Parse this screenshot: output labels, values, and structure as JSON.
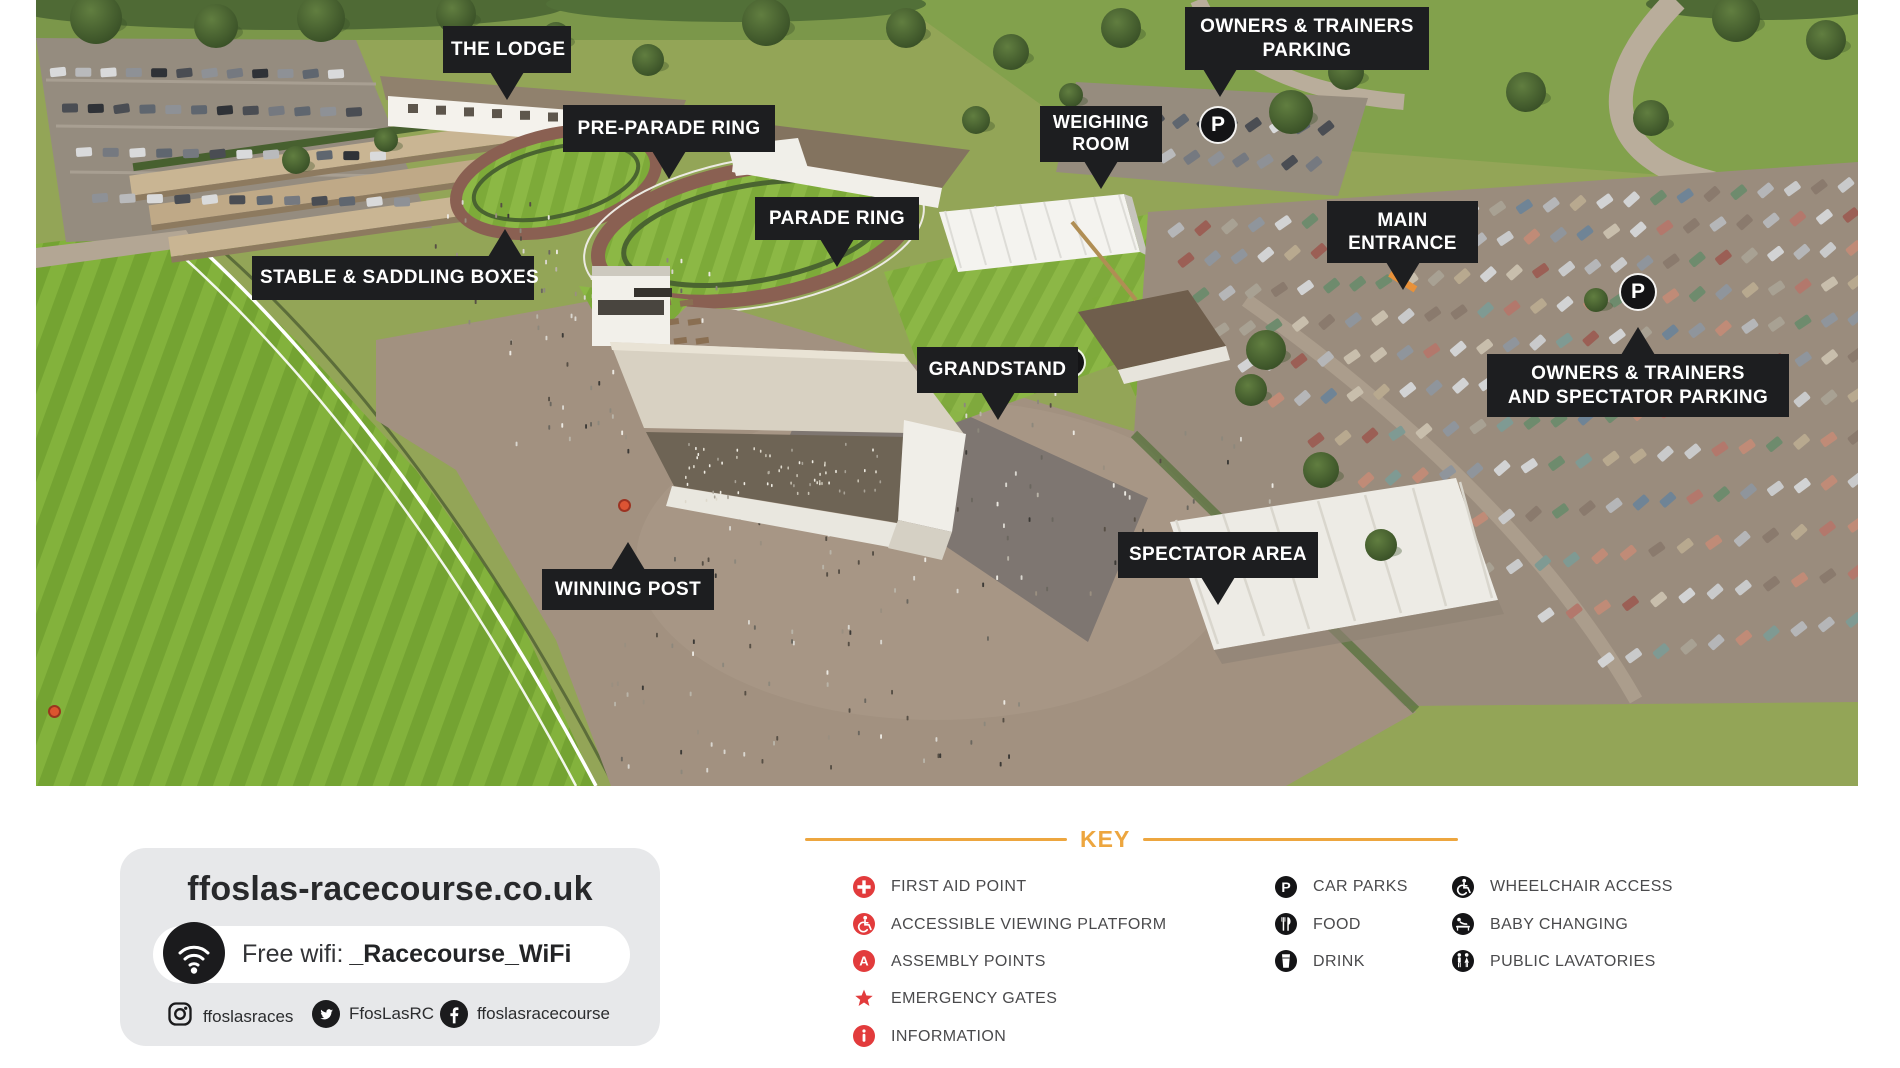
{
  "map": {
    "callouts": [
      {
        "id": "the-lodge",
        "lines": [
          "THE LODGE"
        ]
      },
      {
        "id": "pre-parade-ring",
        "lines": [
          "PRE-PARADE RING"
        ]
      },
      {
        "id": "owners-trainers-parking",
        "lines": [
          "OWNERS & TRAINERS",
          "PARKING"
        ]
      },
      {
        "id": "weighing-room",
        "lines": [
          "WEIGHING",
          "ROOM"
        ]
      },
      {
        "id": "stable-saddling-boxes",
        "lines": [
          "STABLE & SADDLING BOXES"
        ]
      },
      {
        "id": "parade-ring",
        "lines": [
          "PARADE RING"
        ]
      },
      {
        "id": "main-entrance",
        "lines": [
          "MAIN",
          "ENTRANCE"
        ]
      },
      {
        "id": "grandstand",
        "lines": [
          "GRANDSTAND"
        ]
      },
      {
        "id": "owners-trainers-spectator-parking",
        "lines": [
          "OWNERS & TRAINERS",
          "AND SPECTATOR PARKING"
        ]
      },
      {
        "id": "winning-post",
        "lines": [
          "WINNING POST"
        ]
      },
      {
        "id": "spectator-area",
        "lines": [
          "SPECTATOR AREA"
        ]
      }
    ],
    "markers": [
      {
        "type": "car-park",
        "glyph": "P"
      },
      {
        "type": "car-park",
        "glyph": "P"
      },
      {
        "type": "public-lavatories"
      },
      {
        "type": "point-marker"
      },
      {
        "type": "point-marker"
      }
    ]
  },
  "info_panel": {
    "website": "ffoslas-racecourse.co.uk",
    "wifi_label": "Free wifi:",
    "wifi_ssid": "_Racecourse_WiFi",
    "social": [
      {
        "network": "instagram",
        "handle": "ffoslasraces"
      },
      {
        "network": "twitter",
        "handle": "FfosLasRC"
      },
      {
        "network": "facebook",
        "handle": "ffoslasracecourse"
      }
    ]
  },
  "key": {
    "title": "KEY",
    "accent_color": "#EDA63F",
    "red_color": "#E23B3C",
    "black_color": "#141416",
    "columns": [
      [
        {
          "icon": "first-aid-icon",
          "label": "FIRST AID POINT"
        },
        {
          "icon": "accessible-viewing-icon",
          "label": "ACCESSIBLE VIEWING PLATFORM"
        },
        {
          "icon": "assembly-point-icon",
          "label": "ASSEMBLY POINTS"
        },
        {
          "icon": "emergency-gate-icon",
          "label": "EMERGENCY GATES"
        },
        {
          "icon": "information-icon",
          "label": "INFORMATION"
        }
      ],
      [
        {
          "icon": "car-parks-icon",
          "label": "CAR PARKS"
        },
        {
          "icon": "food-icon",
          "label": "FOOD"
        },
        {
          "icon": "drink-icon",
          "label": "DRINK"
        }
      ],
      [
        {
          "icon": "wheelchair-access-icon",
          "label": "WHEELCHAIR ACCESS"
        },
        {
          "icon": "baby-changing-icon",
          "label": "BABY CHANGING"
        },
        {
          "icon": "public-lavatories-icon",
          "label": "PUBLIC LAVATORIES"
        }
      ]
    ]
  }
}
